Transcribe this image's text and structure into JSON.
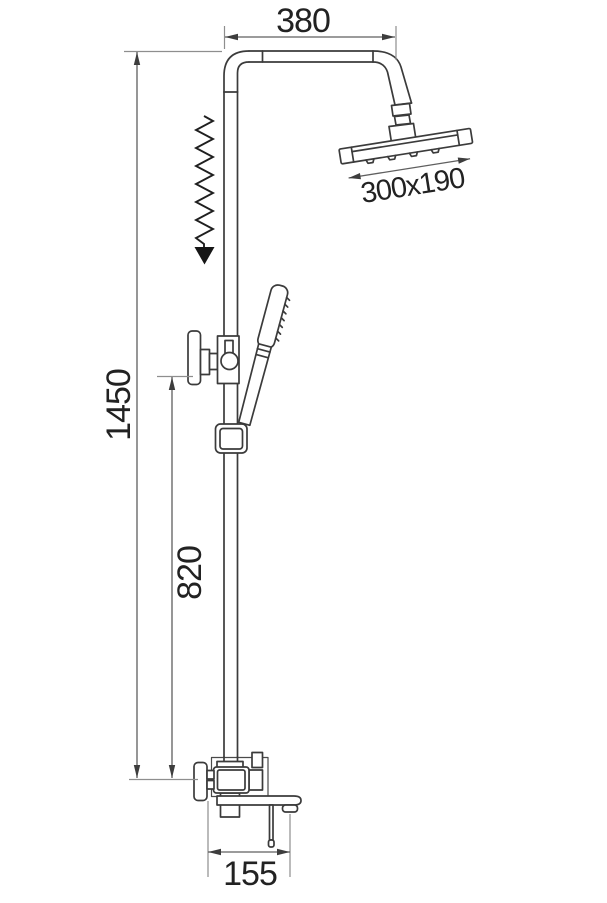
{
  "drawing_title": "shower-column-technical-drawing",
  "dimensions": {
    "top_arm_width": "380",
    "head_size": "300x190",
    "total_height": "1450",
    "lower_section_height": "820",
    "spout_reach": "155"
  },
  "colors": {
    "background": "#ffffff",
    "outline": "#3b3b3b",
    "dimension_line": "#5f5f5f",
    "extension_line": "#8e8e8e",
    "text": "#222222",
    "adjust_arrow": "#161616"
  }
}
